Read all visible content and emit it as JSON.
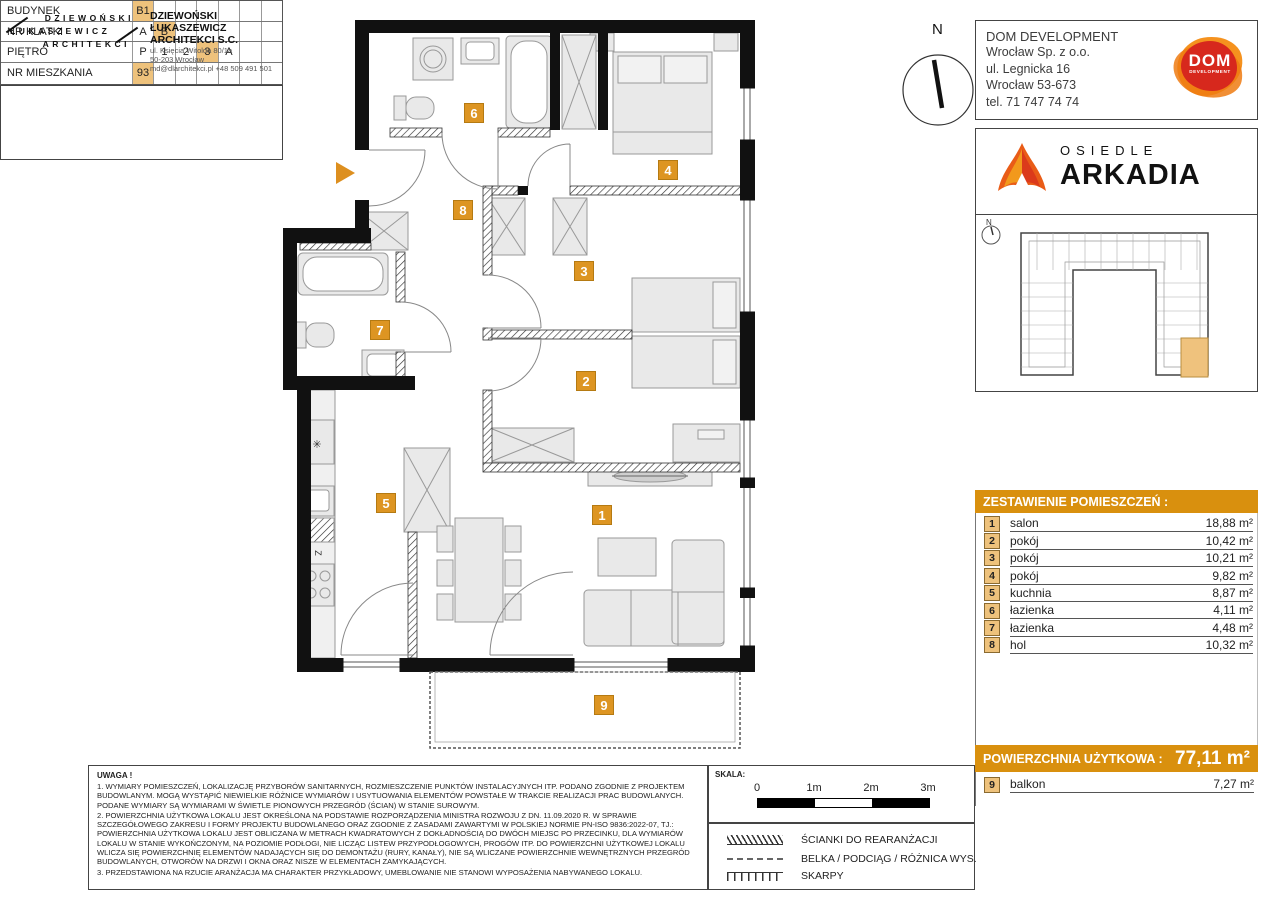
{
  "compass": {
    "label": "N"
  },
  "company": {
    "name": "DOM DEVELOPMENT",
    "address_lines": [
      "Wrocław Sp. z o.o.",
      "ul. Legnicka 16",
      "Wrocław 53-673",
      "tel. 71 747 74 74"
    ],
    "logo": {
      "text": "DOM",
      "subtext": "DEVELOPMENT",
      "color_red": "#d7281d",
      "color_orange": "#f0831e"
    }
  },
  "estate": {
    "prefix": "OSIEDLE",
    "name": "ARKADIA"
  },
  "sitemap": {
    "compass_label": "N",
    "highlight_color": "#efc27d"
  },
  "unit_info": {
    "rows": [
      {
        "label": "BUDYNEK",
        "cells": [
          "B1",
          "",
          "",
          "",
          "",
          "",
          ""
        ]
      },
      {
        "label": "NR KLATKI",
        "cells": [
          "A",
          "B",
          "",
          "",
          "",
          "",
          ""
        ]
      },
      {
        "label": "PIĘTRO",
        "cells": [
          "P",
          "1",
          "2",
          "3",
          "A",
          "",
          ""
        ]
      },
      {
        "label": "NR MIESZKANIA",
        "cells": [
          "93",
          "",
          "",
          "",
          "",
          "",
          ""
        ]
      }
    ]
  },
  "rooms": {
    "title": "ZESTAWIENIE POMIESZCZEŃ :",
    "items": [
      {
        "no": "1",
        "name": "salon",
        "area": "18,88 m²"
      },
      {
        "no": "2",
        "name": "pokój",
        "area": "10,42 m²"
      },
      {
        "no": "3",
        "name": "pokój",
        "area": "10,21 m²"
      },
      {
        "no": "4",
        "name": "pokój",
        "area": "9,82 m²"
      },
      {
        "no": "5",
        "name": "kuchnia",
        "area": "8,87 m²"
      },
      {
        "no": "6",
        "name": "łazienka",
        "area": "4,11 m²"
      },
      {
        "no": "7",
        "name": "łazienka",
        "area": "4,48 m²"
      },
      {
        "no": "8",
        "name": "hol",
        "area": "10,32 m²"
      }
    ]
  },
  "total": {
    "label": "POWIERZCHNIA UŻYTKOWA :",
    "value": "77,11 m²"
  },
  "balcony_row": {
    "no": "9",
    "name": "balkon",
    "area": "7,27 m²"
  },
  "architect": {
    "logo_lines": [
      "DZIEWOŃSKI",
      "ŁUKASZEWICZ",
      "ARCHITEKCI"
    ],
    "name_line1": "DZIEWOŃSKI ŁUKASZEWICZ",
    "name_line2": "ARCHITEKCI S.C.",
    "address_lines": [
      "ul. Księcia Witolda 80/1a",
      "50-203 Wrocław",
      "md@dlarchitekci.pl  +48 509 491 501"
    ]
  },
  "notes": {
    "title": "UWAGA !",
    "paragraphs": [
      "1. WYMIARY POMIESZCZEŃ, LOKALIZACJĘ PRZYBORÓW SANITARNYCH, ROZMIESZCZENIE PUNKTÓW INSTALACYJNYCH ITP. PODANO ZGODNIE Z PROJEKTEM BUDOWLANYM. MOGĄ WYSTĄPIĆ NIEWIELKIE RÓŻNICE WYMIARÓW I USYTUOWANIA ELEMENTÓW POWSTAŁE W TRAKCIE REALIZACJI PRAC BUDOWLANYCH. PODANE WYMIARY SĄ WYMIARAMI W ŚWIETLE PIONOWYCH PRZEGRÓD (ŚCIAN) W STANIE SUROWYM.",
      "2. POWIERZCHNIA UŻYTKOWA LOKALU JEST OKREŚLONA NA PODSTAWIE ROZPORZĄDZENIA MINISTRA ROZWOJU Z DN. 11.09.2020 R. W SPRAWIE SZCZEGÓŁOWEGO ZAKRESU I FORMY PROJEKTU BUDOWLANEGO ORAZ ZGODNIE Z ZASADAMI ZAWARTYMI W POLSKIEJ NORMIE PN-ISO 9836:2022-07, TJ.: POWIERZCHNIA UŻYTKOWA LOKALU JEST OBLICZANA W METRACH KWADRATOWYCH Z DOKŁADNOŚCIĄ DO DWÓCH MIEJSC PO PRZECINKU, DLA WYMIARÓW LOKALU W STANIE WYKOŃCZONYM, NA POZIOMIE PODŁOGI, NIE LICZĄC LISTEW PRZYPODŁOGOWYCH, PROGÓW ITP. DO POWIERZCHNI UŻYTKOWEJ LOKALU WLICZA SIĘ POWIERZCHNIĘ ELEMENTÓW NADAJĄCYCH SIĘ DO DEMONTAŻU (RURY, KANAŁY), NIE SĄ WLICZANE POWIERZCHNIE WEWNĘTRZNYCH PRZEGRÓD BUDOWLANYCH, OTWORÓW NA DRZWI I OKNA ORAZ NISZE W ELEMENTACH ZAMYKAJĄCYCH.",
      "3. PRZEDSTAWIONA NA RZUCIE ARANŻACJA MA CHARAKTER PRZYKŁADOWY, UMEBLOWANIE NIE STANOWI WYPOSAŻENIA NABYWANEGO LOKALU."
    ]
  },
  "scale": {
    "label": "SKALA:",
    "ticks": [
      "0",
      "1m",
      "2m",
      "3m"
    ]
  },
  "legend": {
    "items": [
      {
        "symbol": "hatch-wall",
        "label": "ŚCIANKI DO REARANŻACJI"
      },
      {
        "symbol": "dashed-line",
        "label": "BELKA / PODCIĄG / RÓŻNICA WYS."
      },
      {
        "symbol": "slope-ticks",
        "label": "SKARPY"
      }
    ]
  },
  "plan": {
    "badge_color": "#dd9522",
    "badges": [
      {
        "no": "1"
      },
      {
        "no": "2"
      },
      {
        "no": "3"
      },
      {
        "no": "4"
      },
      {
        "no": "5"
      },
      {
        "no": "6"
      },
      {
        "no": "7"
      },
      {
        "no": "8"
      },
      {
        "no": "9"
      }
    ],
    "kitchen_labels": {
      "fridge": "✳",
      "sink": "Z"
    }
  }
}
